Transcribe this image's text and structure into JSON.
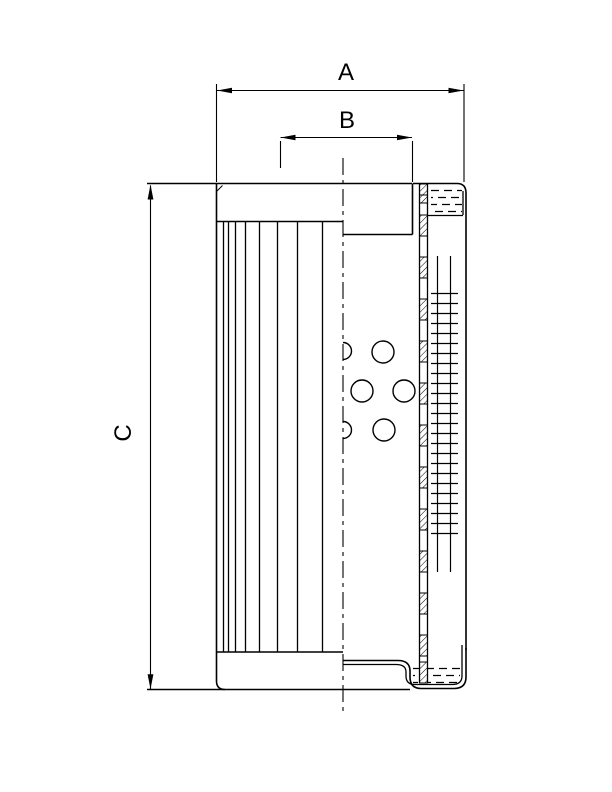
{
  "drawing": {
    "type": "technical-section-drawing",
    "subject": "filter-element",
    "colors": {
      "line": "#000000",
      "background": "#ffffff"
    },
    "dimensions": {
      "a": {
        "label": "A"
      },
      "b": {
        "label": "B"
      },
      "c": {
        "label": "C"
      }
    }
  }
}
